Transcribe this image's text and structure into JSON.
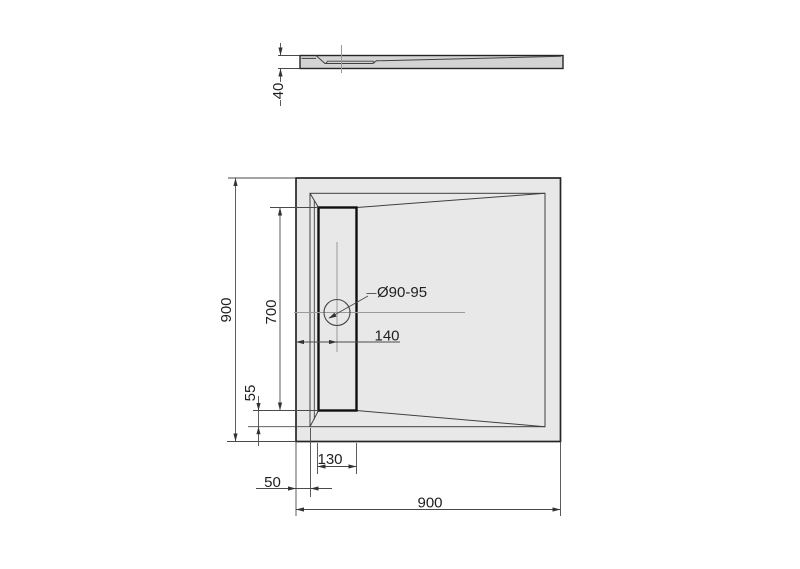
{
  "drawing": {
    "type": "shower-tray-technical-drawing",
    "side_view": {
      "thickness_label": "40"
    },
    "plan_view": {
      "overall_height_label": "900",
      "channel_length_label": "700",
      "channel_bottom_offset_label": "55",
      "drain_center_offset_label": "140",
      "channel_width_label": "130",
      "rim_width_label": "50",
      "overall_width_label": "900",
      "drain_diameter_label": "Ø90-95"
    },
    "colors": {
      "background": "#ffffff",
      "tray_fill": "#e8e8e8",
      "side_section_fill": "#d3d3d3",
      "outline": "#262626",
      "bold_line": "#0f0f0f",
      "thin_line": "#3f3f3f",
      "dimension_line": "#4a4a4a",
      "centerline": "#9a9a9a",
      "text": "#1f1f1f"
    }
  }
}
